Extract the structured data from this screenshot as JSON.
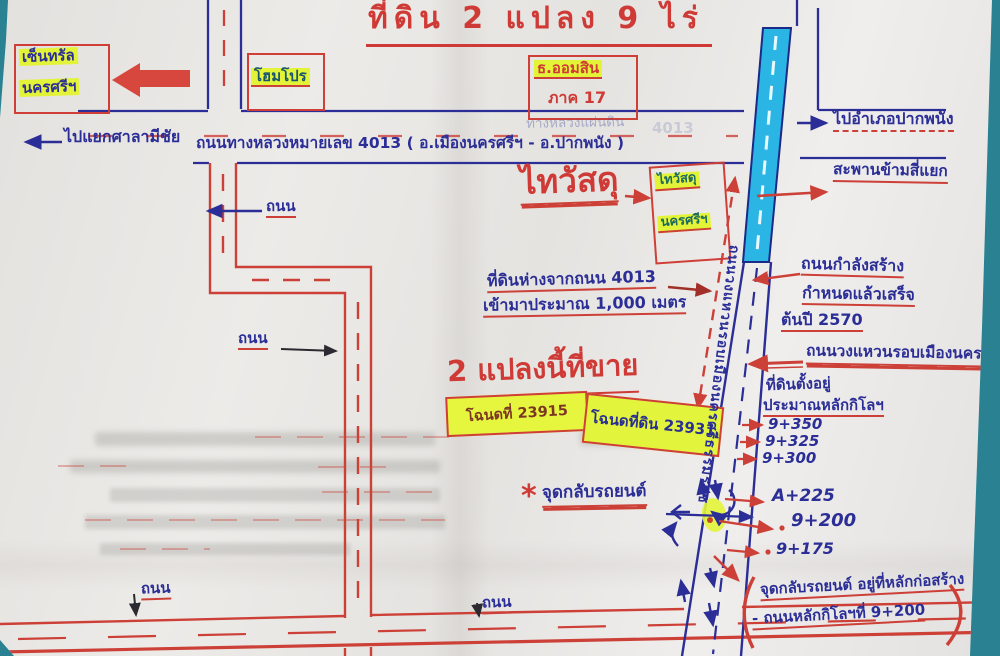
{
  "palette": {
    "red_marker": "#cc4038",
    "blue_pen": "#2b2e96",
    "cyan_highlight": "#2ab5e4",
    "yellow_highlight": "#e3f438",
    "paper": "#e8e6e3",
    "table": "#2a8191"
  },
  "title": "ที่ดิน 2 แปลง 9 ไร่",
  "landmarks": {
    "central_line1": "เซ็นทรัล",
    "central_line2": "นครศรีฯ",
    "homepro": "โฮมโปร",
    "bank_name": "ธ.ออมสิน",
    "bank_region": "ภาค 17",
    "thaiwatsadu": "ไทวัสดุ",
    "thaiwatsadu_box_line1": "ไทวัสดุ",
    "thaiwatsadu_box_line2": "นครศรีฯ"
  },
  "roads": {
    "highway_label": "ถนนทางหลวงหมายเลข 4013 ( อ.เมืองนครศรีฯ - อ.ปากพนัง )",
    "highway_faded": "ทางหลวงแผ่นดิน",
    "highway_faded_no": "4013",
    "to_sala_michai": "ไปแยกศาลามีชัย",
    "to_pak_phanang": "ไปอำเภอปากพนัง",
    "bridge": "สะพานข้ามสี่แยก",
    "road": "ถนน",
    "ring_road_name": "ถนนวงแหวนรอบเมืองนครศรีธรรมราช"
  },
  "notes": {
    "distance_line1": "ที่ดินห่างจากถนน 4013",
    "distance_line2": "เข้ามาประมาณ 1,000 เมตร",
    "construction_line1": "ถนนกำลังสร้าง",
    "construction_line2": "กำหนดแล้วเสร็จ",
    "construction_line3": "ต้นปี 2570",
    "ring_road_label": "ถนนวงแหวนรอบเมืองนคร",
    "location_line1": "ที่ดินตั้งอยู่",
    "location_line2": "ประมาณหลักกิโลฯ",
    "km_markers": [
      "9+350",
      "9+325",
      "9+300",
      "A+225",
      "9+200",
      "9+175"
    ],
    "uturn_star": "*",
    "uturn_label": "จุดกลับรถยนต์",
    "uturn_note_line1": "จุดกลับรถยนต์ อยู่ที่หลักก่อสร้าง",
    "uturn_note_line2": "- ถนนหลักกิโลฯที่ 9+200"
  },
  "sale": {
    "headline": "2 แปลงนี้ที่ขาย",
    "deed1": "โฉนดที่ 23915",
    "deed2": "โฉนดที่ดิน 23931"
  }
}
